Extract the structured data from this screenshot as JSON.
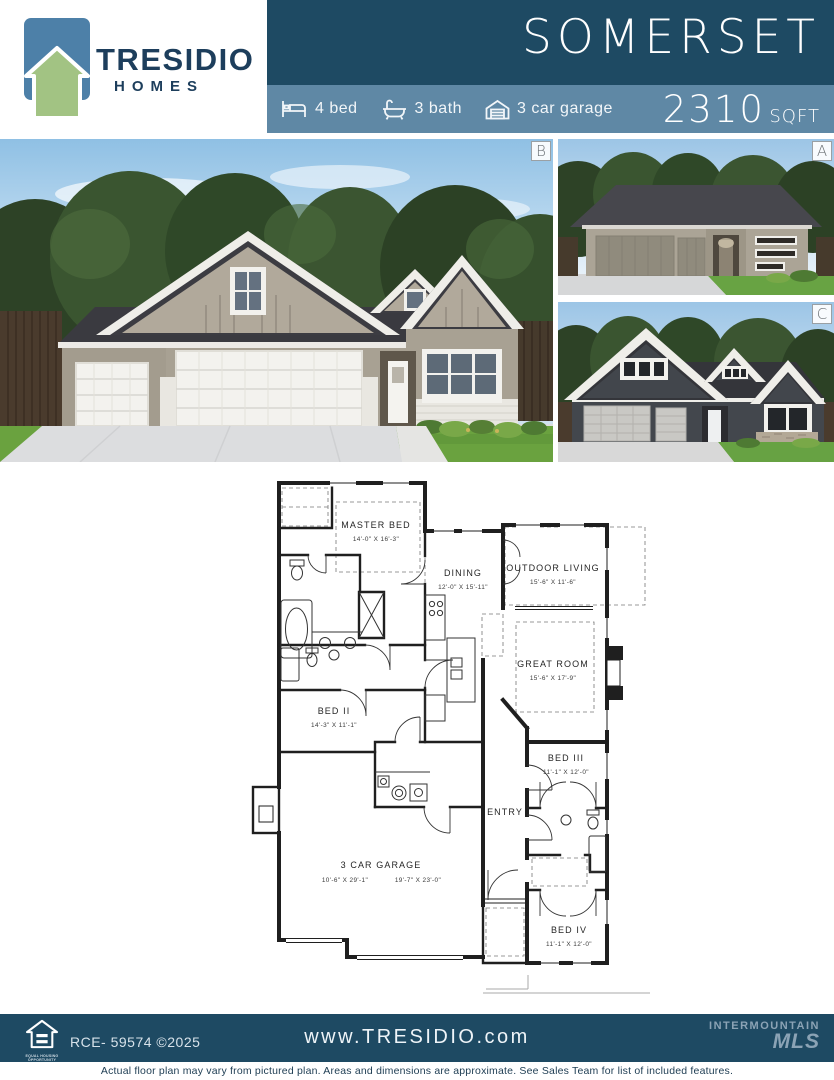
{
  "header": {
    "brand": {
      "name": "TRESIDIO",
      "sub": "HOMES"
    },
    "plan_name": "SOMERSET",
    "specs": [
      {
        "icon": "bed-icon",
        "label": "4 bed"
      },
      {
        "icon": "bath-icon",
        "label": "3 bath"
      },
      {
        "icon": "garage-icon",
        "label": "3 car garage"
      }
    ],
    "sqft_value": "2310",
    "sqft_unit": "SQFT"
  },
  "photos": {
    "main_label": "B",
    "top_right_label": "A",
    "bottom_right_label": "C"
  },
  "floor_plan": {
    "rooms": {
      "master": {
        "name": "MASTER BED",
        "dims": "14'-0\" X 16'-3\""
      },
      "dining": {
        "name": "DINING",
        "dims": "12'-0\" X 15'-11\""
      },
      "outdoor": {
        "name": "OUTDOOR LIVING",
        "dims": "15'-6\" X 11'-6\""
      },
      "great": {
        "name": "GREAT ROOM",
        "dims": "15'-6\" X 17'-9\""
      },
      "bed2": {
        "name": "BED II",
        "dims": "14'-3\" X 11'-1\""
      },
      "bed3": {
        "name": "BED III",
        "dims": "11'-1\" X 12'-0\""
      },
      "entry": {
        "name": "ENTRY"
      },
      "garage": {
        "name": "3 CAR GARAGE",
        "dims_left": "10'-6\" X 29'-1\"",
        "dims_right": "19'-7\" X 23'-0\""
      },
      "bed4": {
        "name": "BED IV",
        "dims": "11'-1\" X 12'-0\""
      }
    }
  },
  "footer": {
    "eho_line1": "EQUAL HOUSING",
    "eho_line2": "OPPORTUNITY",
    "license": "RCE- 59574 ©2025",
    "website": "www.TRESIDIO.com",
    "mls_line1": "INTERMOUNTAIN",
    "mls_line2": "MLS",
    "disclaimer": "Actual floor plan may vary from pictured plan. Areas and dimensions are approximate. See Sales Team for list of included features."
  },
  "colors": {
    "band_dark": "#1e4a63",
    "band_light": "#5f88a5",
    "logo_blue": "#4d80a8",
    "logo_green": "#a2c383",
    "brand_navy": "#1d3e5c",
    "mls_gray_blue": "#8ba3b5"
  }
}
